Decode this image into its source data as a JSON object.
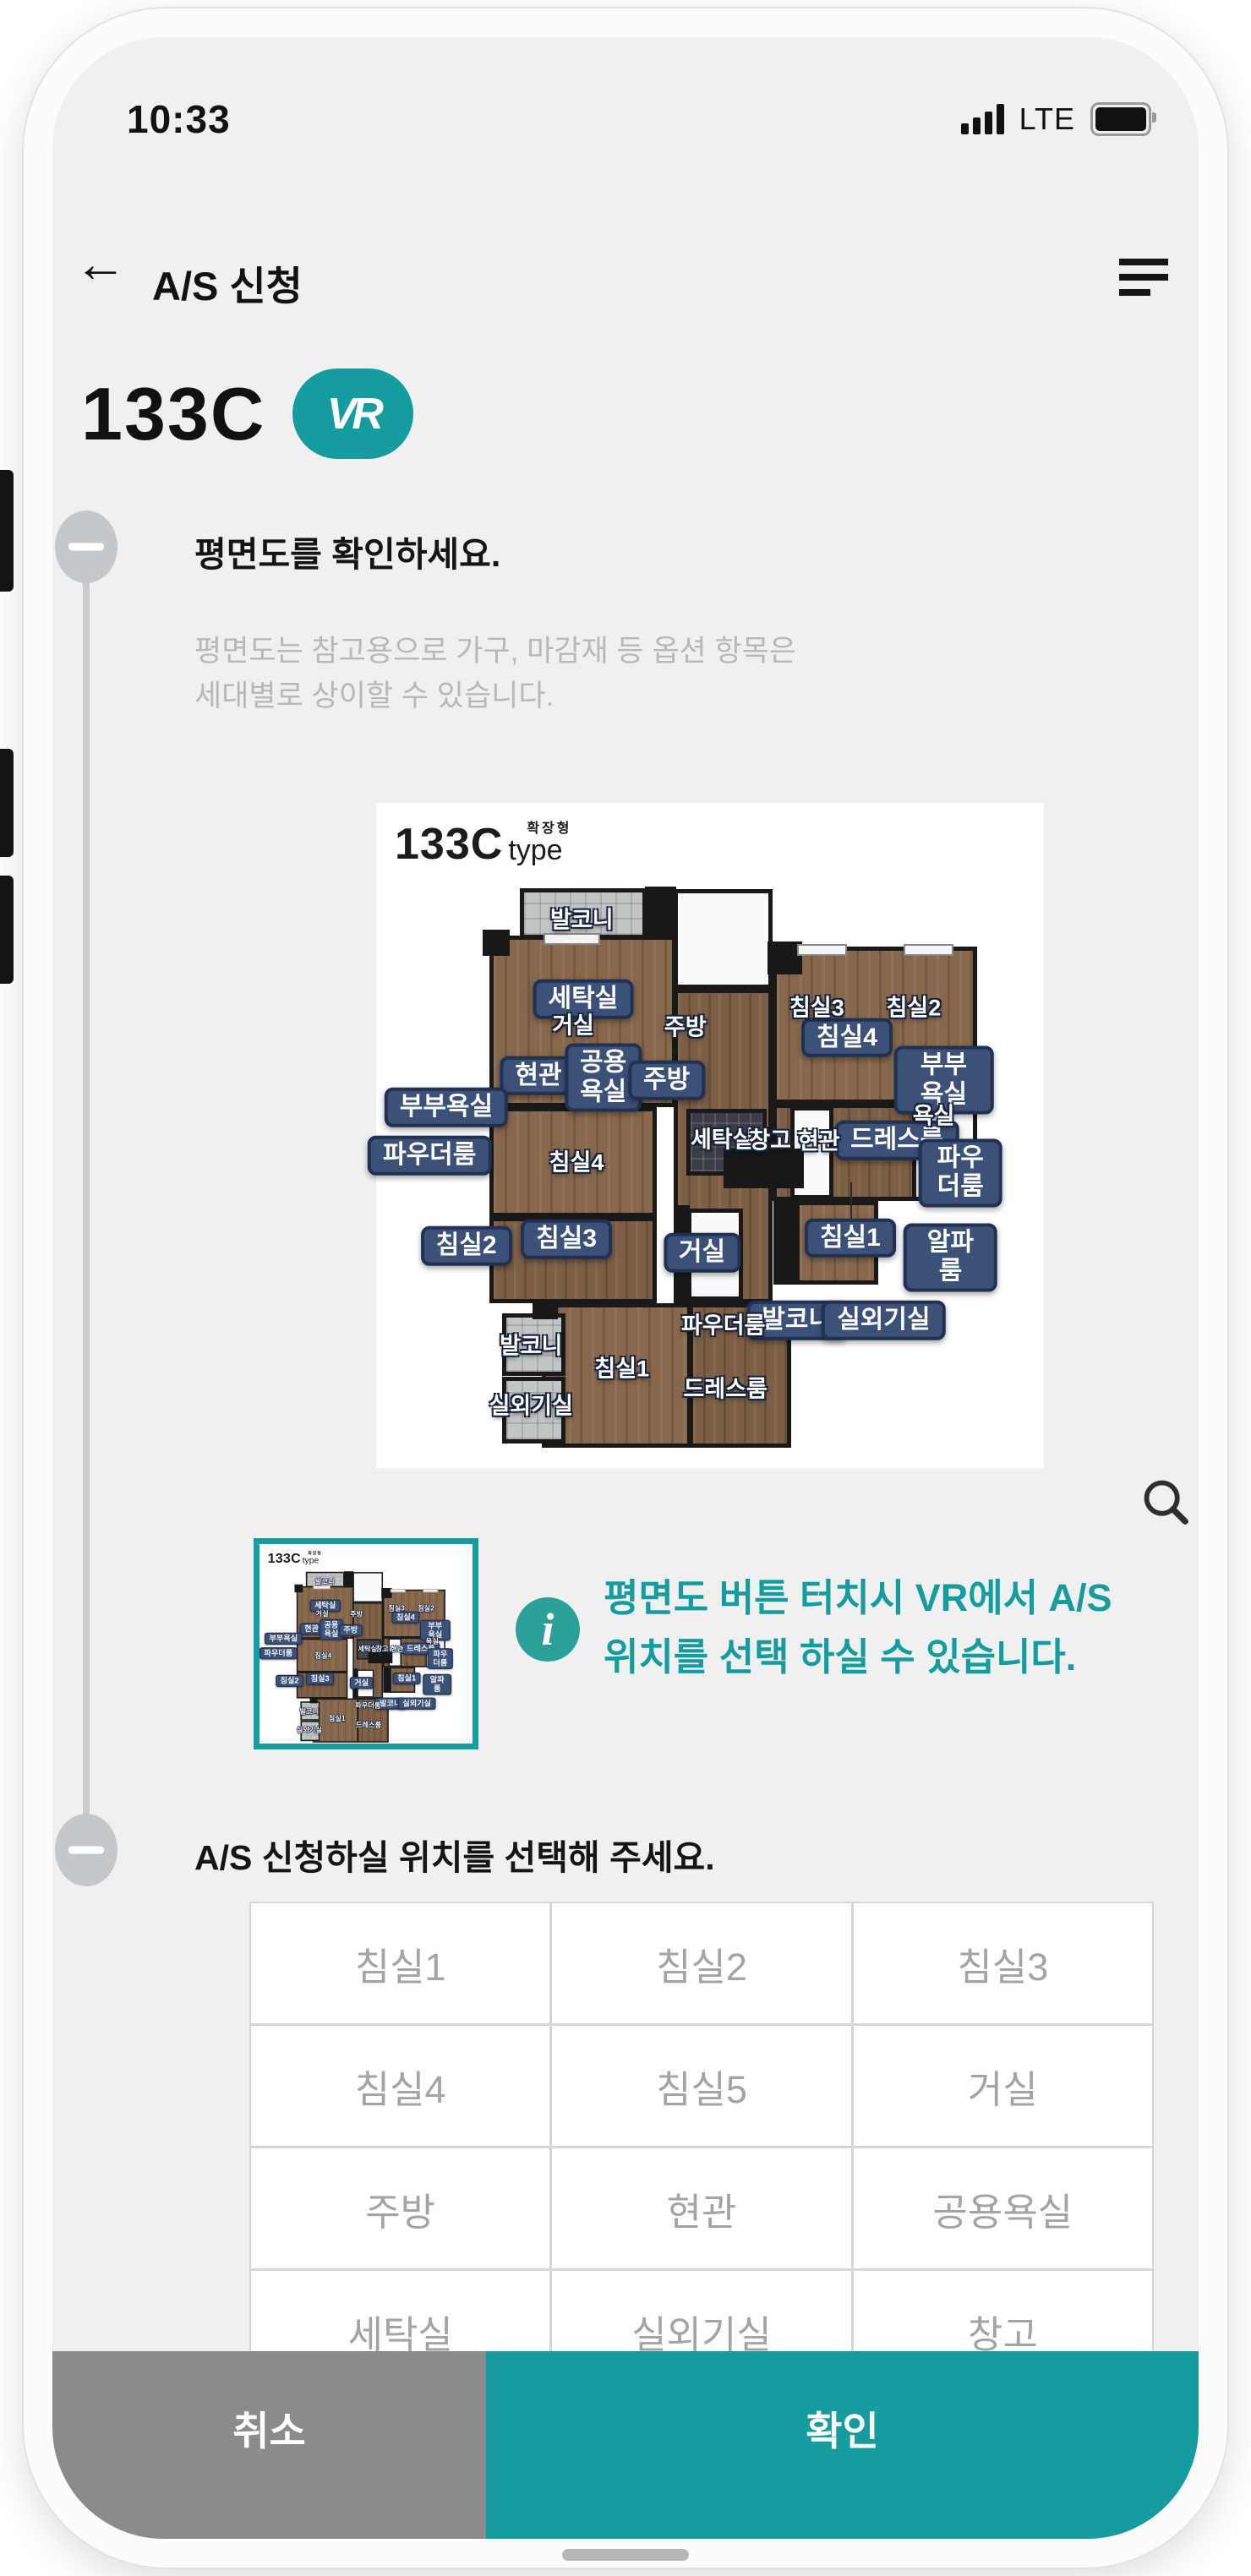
{
  "colors": {
    "accent": "#149c9e",
    "badge": "#3c5178",
    "badgeb": "#203152",
    "cancel_gray": "#8b8b8b",
    "floor_brown": "#87684c"
  },
  "status_bar": {
    "time": "10:33",
    "network": "LTE"
  },
  "header": {
    "back_glyph": "←",
    "title": "A/S 신청"
  },
  "unit": {
    "code": "133C",
    "vr_label": "VR"
  },
  "section1": {
    "title": "평면도를 확인하세요.",
    "desc_line1": "평면도는 참고용으로 가구, 마감재 등 옵션 항목은",
    "desc_line2": "세대별로 상이할 수 있습니다.",
    "floorplan": {
      "logo": {
        "code": "133C",
        "variant": "확장형",
        "type_label": "type"
      },
      "labels": [
        {
          "style": "badge",
          "text": "세탁실",
          "x": 31,
          "y": 29.5
        },
        {
          "style": "badge",
          "text": "현관",
          "x": 24.3,
          "y": 41
        },
        {
          "style": "badge",
          "text": "공용\n욕실",
          "x": 34,
          "y": 41.3
        },
        {
          "style": "badge",
          "text": "주방",
          "x": 43.5,
          "y": 41.7
        },
        {
          "style": "badge",
          "text": "부부욕실",
          "x": 10.5,
          "y": 45.8
        },
        {
          "style": "badge",
          "text": "파우더룸",
          "x": 8,
          "y": 53
        },
        {
          "style": "badge",
          "text": "침실2",
          "x": 13.5,
          "y": 66.6
        },
        {
          "style": "badge",
          "text": "침실3",
          "x": 28.5,
          "y": 65.6
        },
        {
          "style": "badge",
          "text": "거실",
          "x": 48.8,
          "y": 67.6
        },
        {
          "style": "badge",
          "text": "침실4",
          "x": 70.5,
          "y": 35.3
        },
        {
          "style": "badge",
          "text": "부부욕실",
          "x": 85,
          "y": 41.7
        },
        {
          "style": "badge",
          "text": "드레스룸",
          "x": 78,
          "y": 50.7
        },
        {
          "style": "badge",
          "text": "파우더룸",
          "x": 87.5,
          "y": 55.6
        },
        {
          "style": "badge",
          "text": "침실1",
          "x": 71,
          "y": 65.4
        },
        {
          "style": "badge",
          "text": "알파룸",
          "x": 86,
          "y": 68.3
        },
        {
          "style": "badge",
          "text": "발코니",
          "x": 63,
          "y": 77.8
        },
        {
          "style": "badge",
          "text": "실외기실",
          "x": 76,
          "y": 77.8
        },
        {
          "style": "plain",
          "text": "발코니",
          "x": 30.8,
          "y": 17.3
        },
        {
          "style": "plain",
          "text": "거실",
          "x": 29.5,
          "y": 33.2
        },
        {
          "style": "plain",
          "text": "주방",
          "x": 46.3,
          "y": 33.4
        },
        {
          "style": "plain",
          "text": "침실3",
          "x": 66,
          "y": 30.5
        },
        {
          "style": "plain",
          "text": "침실2",
          "x": 80.5,
          "y": 30.5
        },
        {
          "style": "plain",
          "text": "욕실",
          "x": 83.5,
          "y": 46.8
        },
        {
          "style": "plain",
          "text": "세탁실",
          "x": 51.8,
          "y": 50.3
        },
        {
          "style": "plain",
          "text": "창고",
          "x": 59,
          "y": 50.5
        },
        {
          "style": "plain",
          "text": "현관",
          "x": 66.3,
          "y": 50.6
        },
        {
          "style": "plain",
          "text": "침실4",
          "x": 30,
          "y": 53.8
        },
        {
          "style": "plain",
          "text": "파우더룸",
          "x": 52,
          "y": 78.3
        },
        {
          "style": "plain",
          "text": "발코니",
          "x": 23.2,
          "y": 81.3
        },
        {
          "style": "plain",
          "text": "침실1",
          "x": 36.8,
          "y": 84.8
        },
        {
          "style": "plain",
          "text": "실외기실",
          "x": 23.2,
          "y": 90.3
        },
        {
          "style": "plain",
          "text": "드레스룸",
          "x": 52.3,
          "y": 87.8
        }
      ]
    },
    "info_line1": "평면도 버튼 터치시 VR에서 A/S",
    "info_line2": "위치를 선택 하실 수 있습니다.",
    "info_icon_glyph": "i"
  },
  "section2": {
    "title": "A/S 신청하실 위치를 선택해 주세요.",
    "locations": [
      "침실1",
      "침실2",
      "침실3",
      "침실4",
      "침실5",
      "거실",
      "주방",
      "현관",
      "공용욕실",
      "세탁실",
      "실외기실",
      "창고"
    ]
  },
  "footer": {
    "cancel": "취소",
    "confirm": "확인"
  }
}
